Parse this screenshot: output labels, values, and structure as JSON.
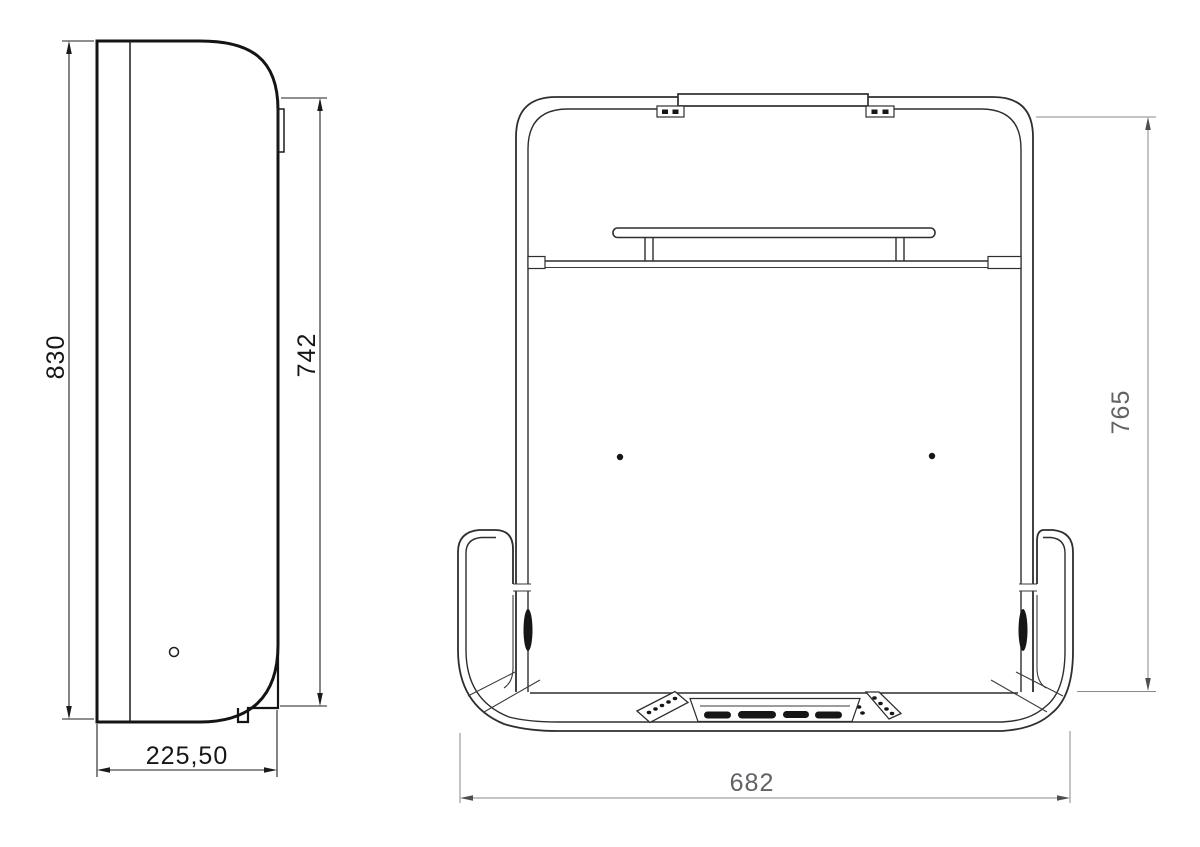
{
  "side_view": {
    "height_label": "830",
    "front_height_label": "742",
    "depth_label": "225,50"
  },
  "front_view": {
    "width_label": "682",
    "height_label": "765"
  },
  "colors": {
    "background": "#ffffff",
    "side_line": "#141414",
    "front_line": "#2e2e2e",
    "dimension_line_front": "#8a8a8a",
    "dimension_text_side": "#161616",
    "dimension_text_front": "#5f6367"
  }
}
